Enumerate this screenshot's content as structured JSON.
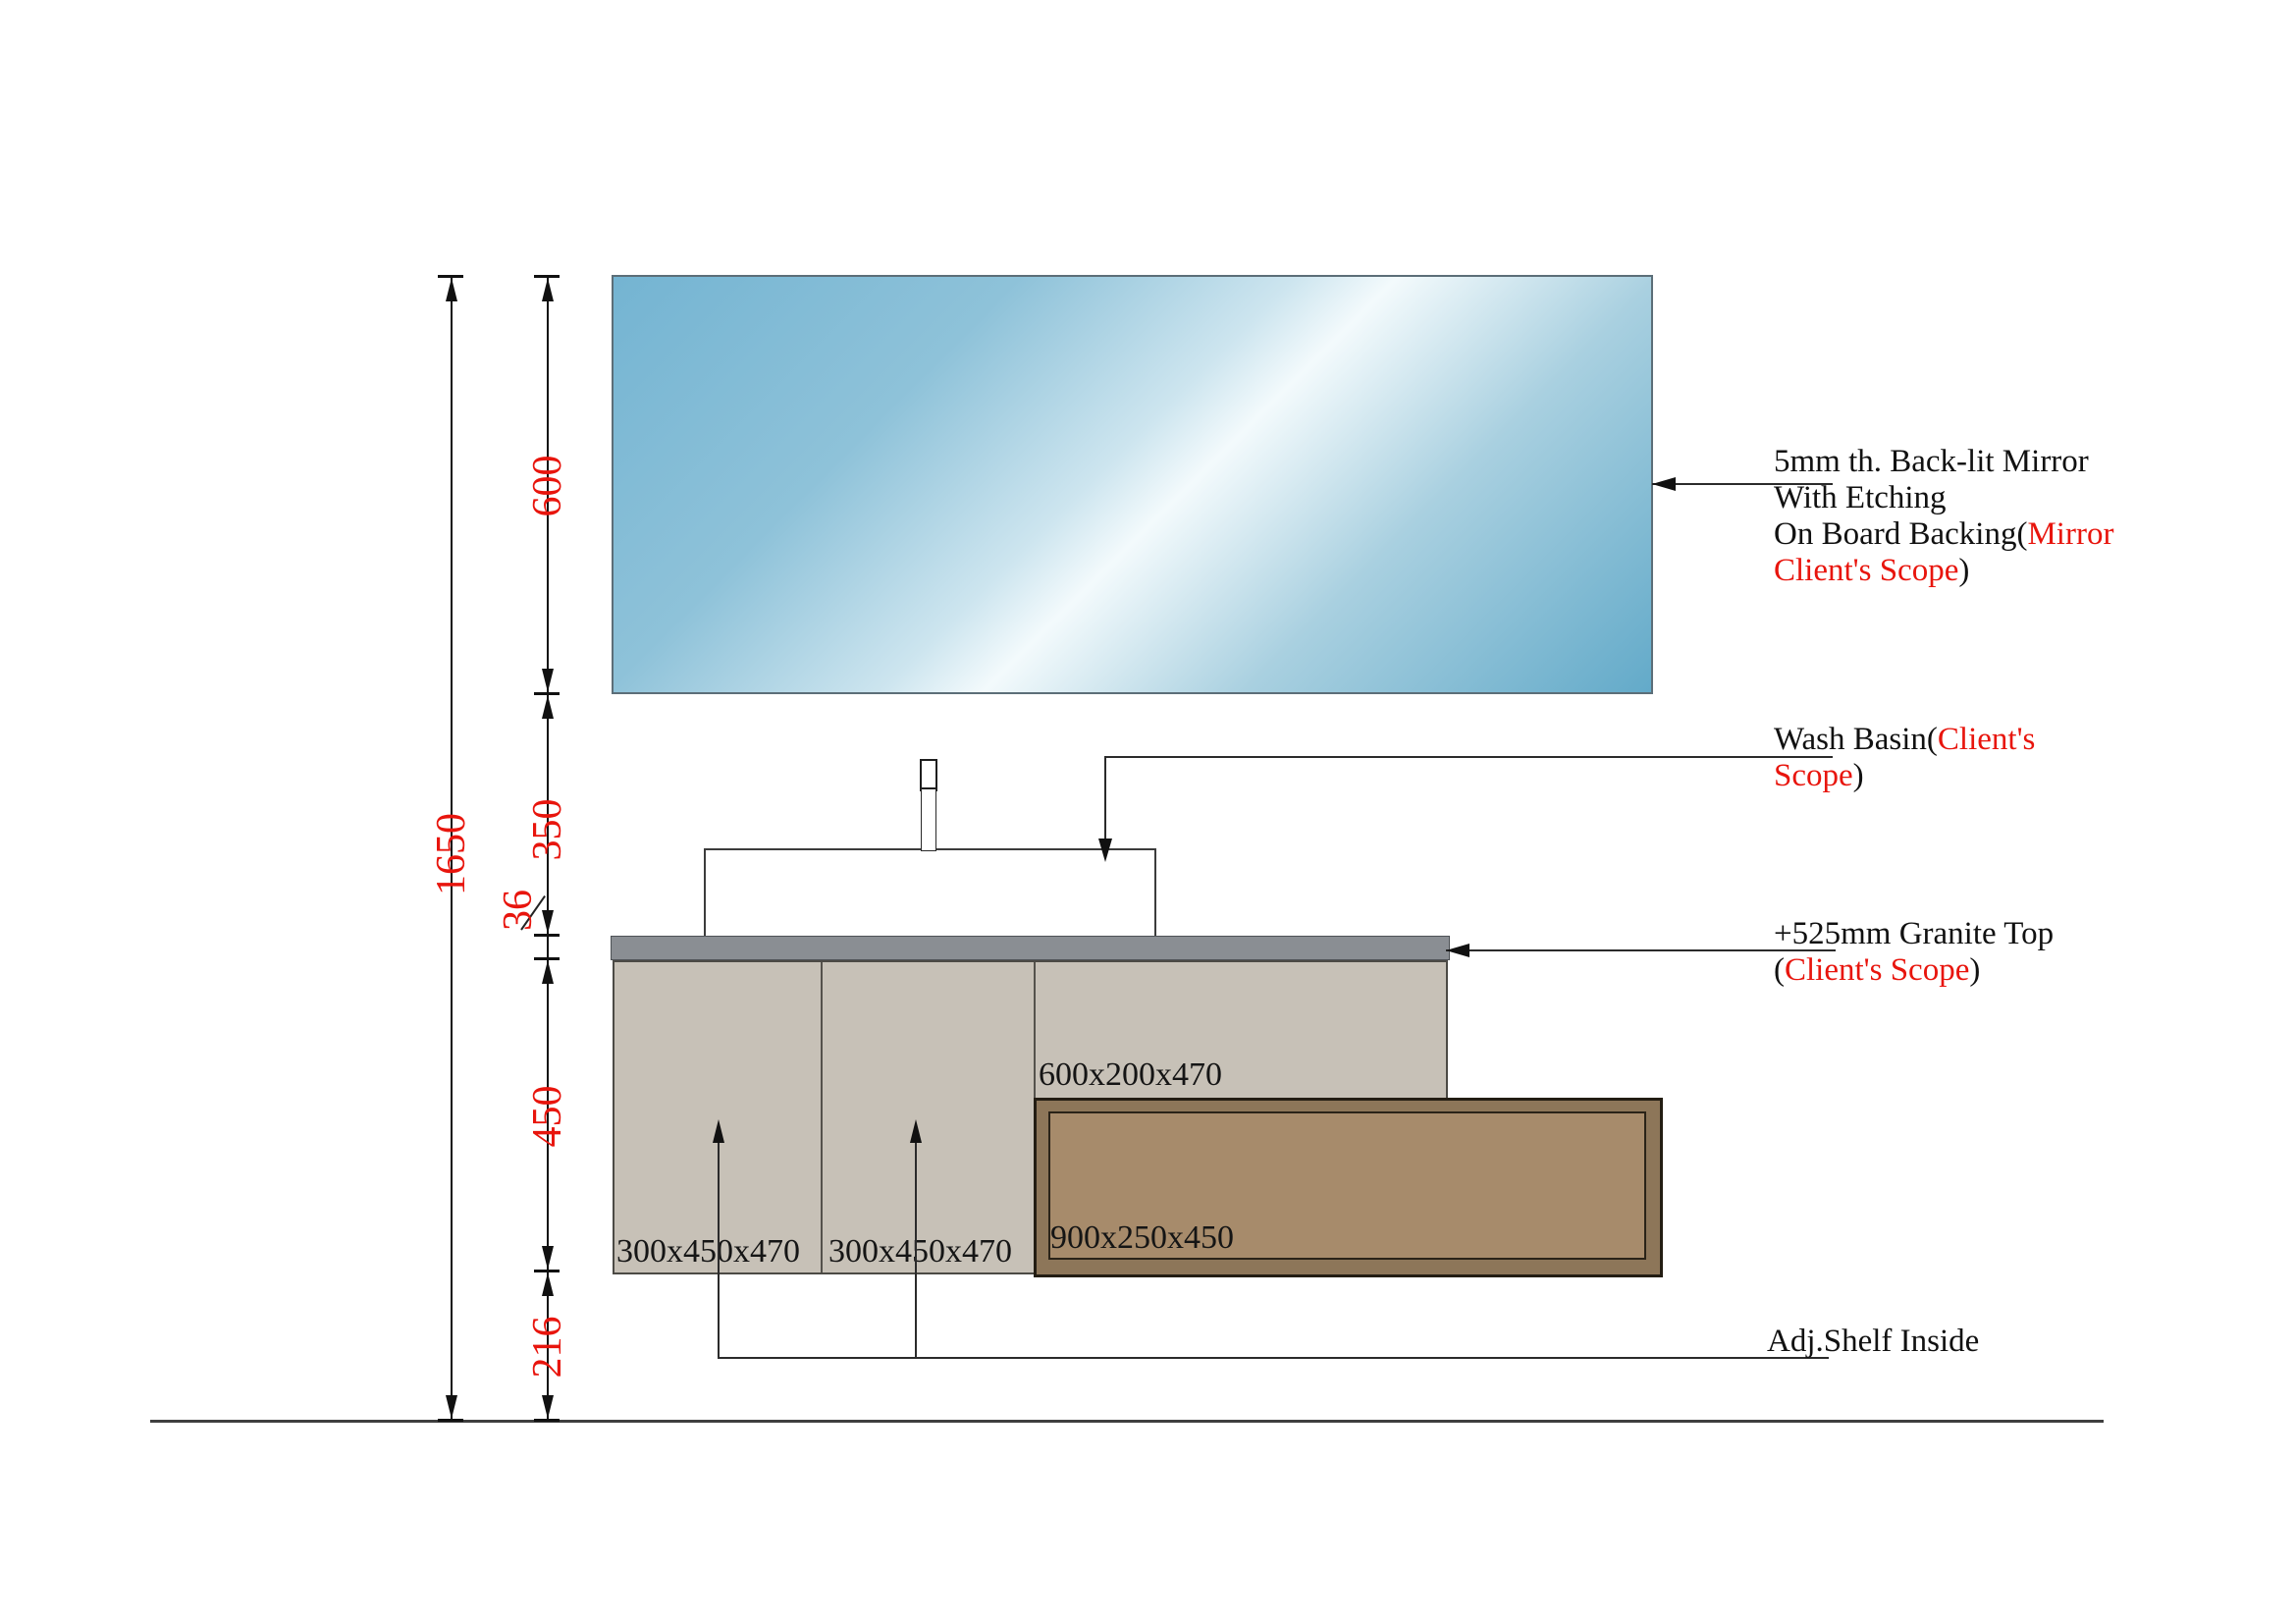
{
  "drawing": {
    "title": "Vanity elevation drawing",
    "dimensions": {
      "total_height": "1650",
      "mirror_height": "600",
      "mirror_to_counter": "350",
      "counter_thickness": "36",
      "cabinet_height": "450",
      "bottom_clearance": "216"
    },
    "cabinet_labels": {
      "left_unit": "300x450x470",
      "middle_unit": "300x450x470",
      "upper_right_unit": "600x200x470",
      "drawer_box": "900x250x450"
    },
    "annotations": {
      "mirror": {
        "line1": "5mm th. Back-lit Mirror",
        "line2": "With Etching",
        "line3_black": "On Board Backing(",
        "line3_red": "Mirror",
        "line4_red": "Client's Scope",
        "line4_black": ")"
      },
      "wash_basin": {
        "line1_black": "Wash Basin(",
        "line1_red": "Client's",
        "line2_red": "Scope",
        "line2_black": ")"
      },
      "granite": {
        "line1": "+525mm Granite Top",
        "line2_open": "(",
        "line2_red": "Client's Scope",
        "line2_close": ")"
      },
      "shelf": {
        "line1": "Adj.Shelf Inside"
      }
    },
    "colors": {
      "dimension_text": "#e8150d",
      "annotation_red": "#e8150d",
      "line_black": "#111111",
      "mirror_blue": "#74b4d2",
      "granite_gray": "#8a8e93",
      "cabinet_beige": "#c7c1b7",
      "drawer_brown_fill": "#a78b6b",
      "drawer_brown_frame": "#8d7659"
    }
  }
}
